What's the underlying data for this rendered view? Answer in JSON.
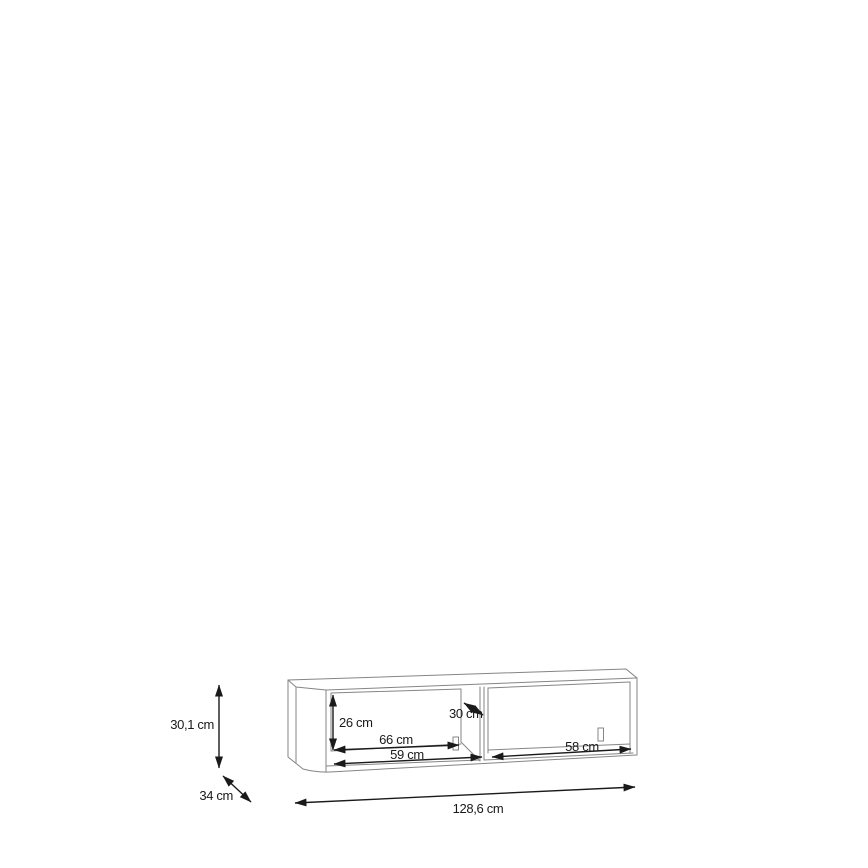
{
  "diagram": {
    "kind": "furniture-dimension-drawing",
    "labels": {
      "overall_height": "30,1 cm",
      "overall_depth": "34 cm",
      "overall_width": "128,6 cm",
      "inner_height": "26 cm",
      "divider_depth": "30 cm",
      "left_compartment_width": "66 cm",
      "left_compartment_front_width": "59 cm",
      "right_compartment_width": "58 cm"
    },
    "values_cm": {
      "overall_height": 30.1,
      "overall_depth": 34,
      "overall_width": 128.6,
      "inner_height": 26,
      "divider_depth": 30,
      "left_compartment_width": 66,
      "left_compartment_front_width": 59,
      "right_compartment_width": 58
    },
    "colors": {
      "background": "#ffffff",
      "furniture_line": "#858585",
      "dimension_line": "#1a1a1a",
      "text": "#1a1a1a"
    }
  }
}
